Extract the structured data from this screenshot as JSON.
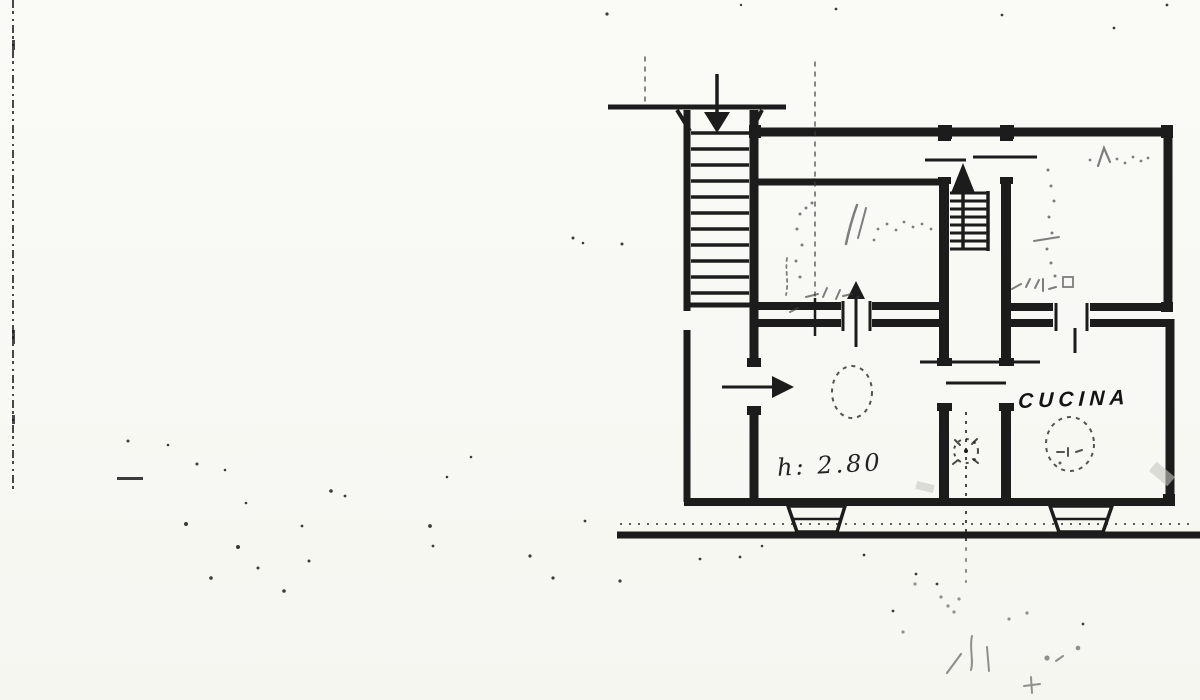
{
  "colors": {
    "ink": "#1c1c1c",
    "paper": "#fafaf7",
    "pencil": "#3c3c3c",
    "smudge": "#c8c8c2"
  },
  "plan": {
    "labels": {
      "kitchen": "CUCINA",
      "ceiling_height": "h: 2.80"
    },
    "icons": [
      {
        "name": "stair-down-arrow",
        "glyph": "↓"
      },
      {
        "name": "stair-up-arrow",
        "glyph": "↑"
      },
      {
        "name": "entrance-arrow",
        "glyph": "→"
      },
      {
        "name": "door-up-arrow",
        "glyph": "↑"
      }
    ]
  }
}
